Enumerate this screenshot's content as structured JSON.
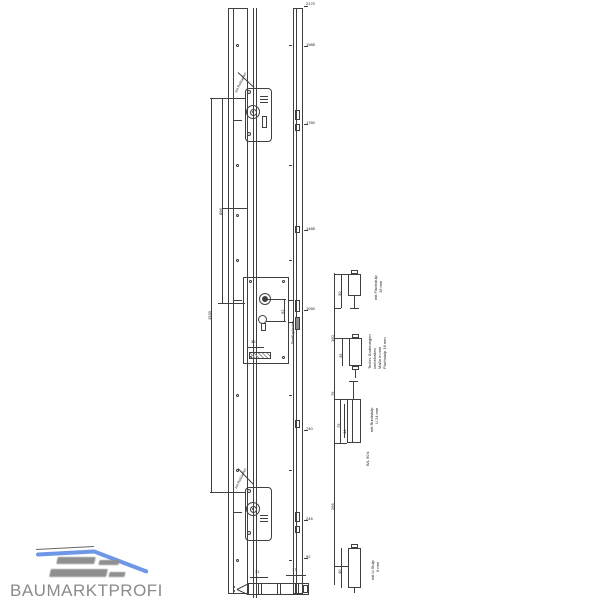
{
  "brand": {
    "name": "BAUMARKTPROFI"
  },
  "colors": {
    "line": "#3f3f3f",
    "logo_gray": "#8b8b8b",
    "logo_blue": "#6f97e8"
  },
  "labels": {
    "top_lock": "mit Rollzapfen",
    "bottom_lock": "mit Rollzapfen",
    "rail_side": "Profilzylinder",
    "backset": "35",
    "pz_distance": "92",
    "left_dim_total": "1933",
    "left_dim_upper": "896",
    "bottom_dim_a": "31",
    "bottom_dim_b": "17"
  },
  "ruler": [
    "2170",
    "1985",
    "1760",
    "1485",
    "1050",
    "740",
    "245",
    "92"
  ],
  "details": {
    "spine": {
      "d1": "150",
      "d2": "75",
      "d3": "295"
    },
    "g1": {
      "dim": "30",
      "l1": "mit Flachstulp",
      "l2": "16 mm"
    },
    "g2": {
      "dim": "35",
      "l1": "Techn. Änderungen",
      "l2": "vorbehalten",
      "l3": "Maße in mm",
      "l4": "Flachstulp 16 mm"
    },
    "g3": {
      "dim": "75",
      "dim2": "44",
      "l1": "mit Rundstulp",
      "l2": "U 24 mm",
      "l3": "B/L 90 li."
    },
    "g4": {
      "dim": "40",
      "l1": "mit U-Stulp",
      "l2": "6 mm"
    }
  }
}
